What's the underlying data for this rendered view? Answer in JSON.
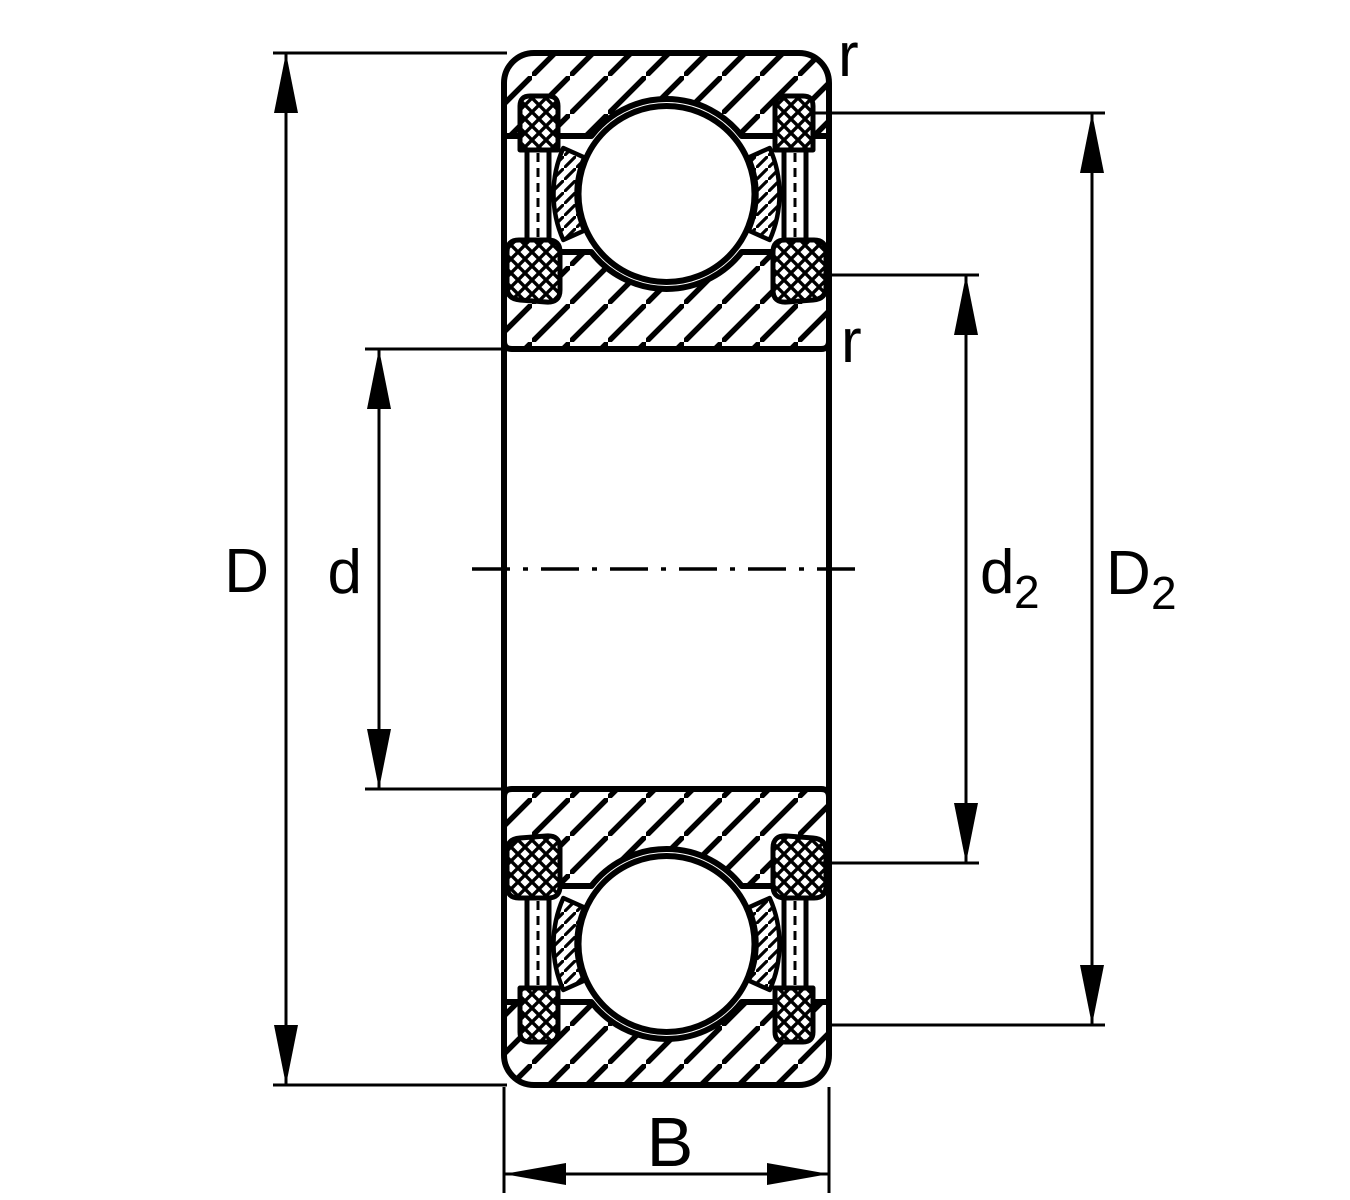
{
  "figure": {
    "description": "Technical cross-section drawing of a sealed deep groove ball bearing with dimension lines",
    "background_color": "#ffffff",
    "line_color": "#000000"
  },
  "labels": {
    "outer_diameter": "D",
    "bore_diameter": "d",
    "inner_recess_diameter_main": "d",
    "inner_recess_diameter_sub": "2",
    "outer_recess_diameter_main": "D",
    "outer_recess_diameter_sub": "2",
    "width": "B",
    "chamfer_radius_outer": "r",
    "chamfer_radius_inner": "r"
  }
}
